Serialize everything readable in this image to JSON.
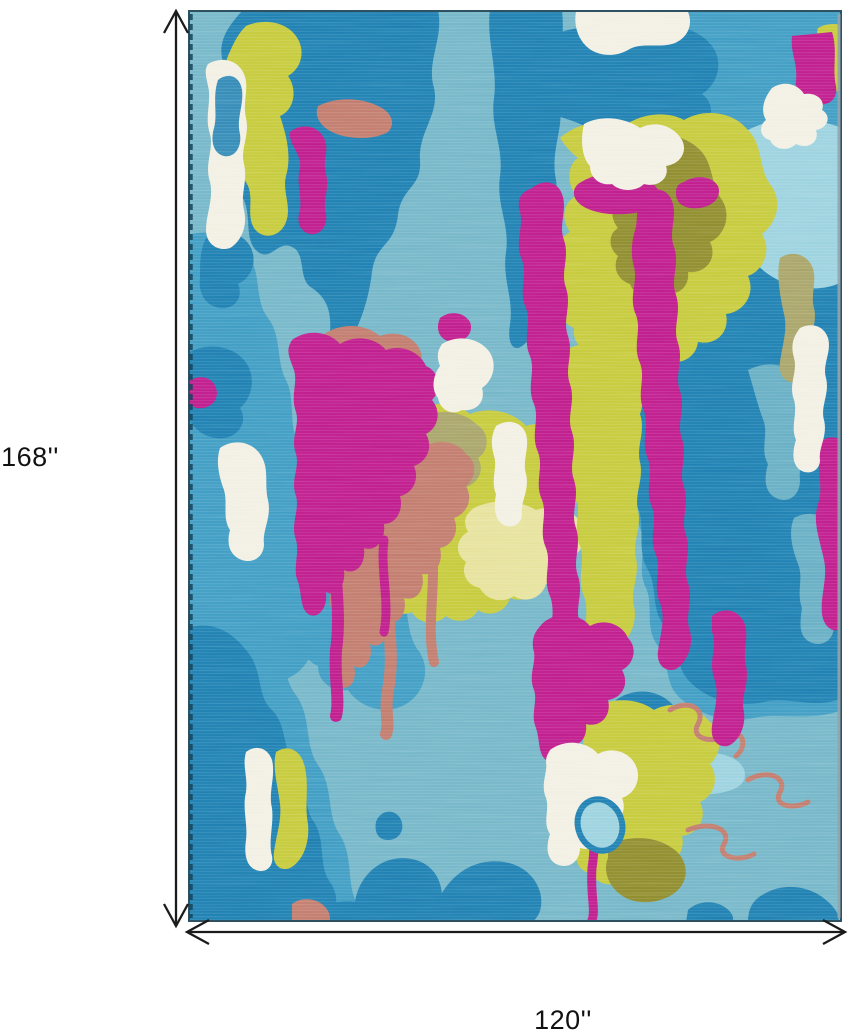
{
  "figure": {
    "height_label": "168''",
    "width_label": "120''"
  },
  "palette": {
    "canvas_bg": "#ffffff",
    "arrow": "#1b1b1b",
    "label_text": "#111111",
    "rug_base": "#74b6c8",
    "rug_teal_medium": "#3f9cc3",
    "rug_teal_light": "#9bd2df",
    "rug_blue_dark": "#1f7fb1",
    "rug_chartreuse": "#c6ca3b",
    "rug_olive": "#8f8c2e",
    "rug_sage": "#a8a469",
    "rug_pale_yellow": "#e6e29c",
    "rug_magenta": "#bf1d8c",
    "rug_salmon": "#c17b6c",
    "rug_white": "#f2efe3",
    "rug_border": "#2e5261",
    "rug_stitch": "#17455c",
    "rug_edge_right": "#93a5ad"
  }
}
